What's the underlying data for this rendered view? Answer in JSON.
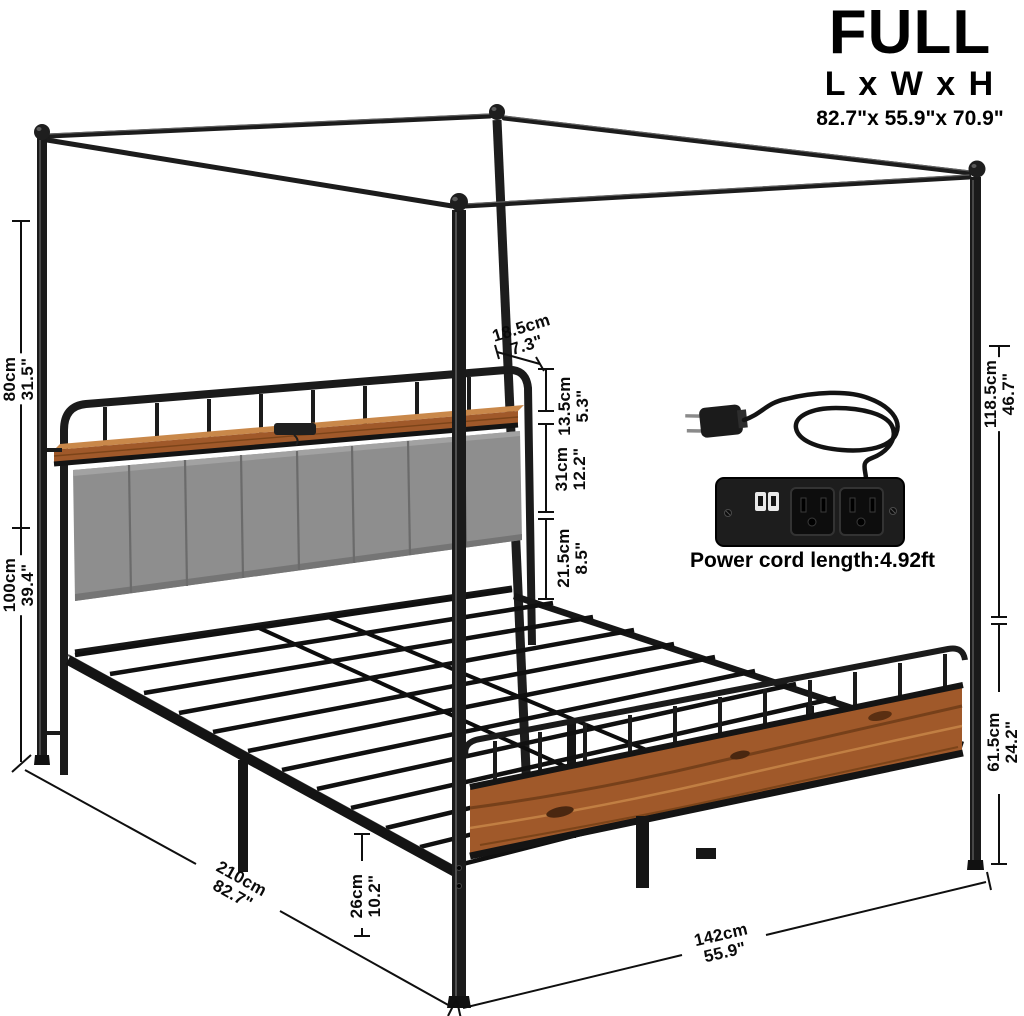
{
  "header": {
    "size": "FULL",
    "dimension_label": "L x W x H",
    "dimension_value": "82.7\"x 55.9\"x 70.9\""
  },
  "power_outlet": {
    "caption": "Power cord length:4.92ft",
    "features": [
      "usb-ports-icon",
      "power-outlet-icon",
      "power-plug-icon"
    ]
  },
  "dimensions": {
    "canopy_post_upper": {
      "cm": "80cm",
      "inch": "31.5\""
    },
    "headboard_total": {
      "cm": "100cm",
      "inch": "39.4\""
    },
    "shelf_depth": {
      "cm": "18.5cm",
      "inch": "7.3\""
    },
    "headboard_rail": {
      "cm": "13.5cm",
      "inch": "5.3\""
    },
    "headboard_cushion": {
      "cm": "31cm",
      "inch": "12.2\""
    },
    "headboard_lower": {
      "cm": "21.5cm",
      "inch": "8.5\""
    },
    "canopy_post_foot": {
      "cm": "118.5cm",
      "inch": "46.7\""
    },
    "footboard_height": {
      "cm": "61.5cm",
      "inch": "24.2\""
    },
    "bed_length": {
      "cm": "210cm",
      "inch": "82.7\""
    },
    "under_bed_clearance": {
      "cm": "26cm",
      "inch": "10.2\""
    },
    "bed_width": {
      "cm": "142cm",
      "inch": "55.9\""
    }
  },
  "colors": {
    "metal": "#1a1a1a",
    "wood": "#a0592a",
    "wood_dark": "#6b3a16",
    "wood_light": "#c9884a",
    "fabric": "#8e8e8e",
    "fabric_seam": "#6b6b6b",
    "dimension_line": "#0f0f0f",
    "background": "#ffffff"
  }
}
